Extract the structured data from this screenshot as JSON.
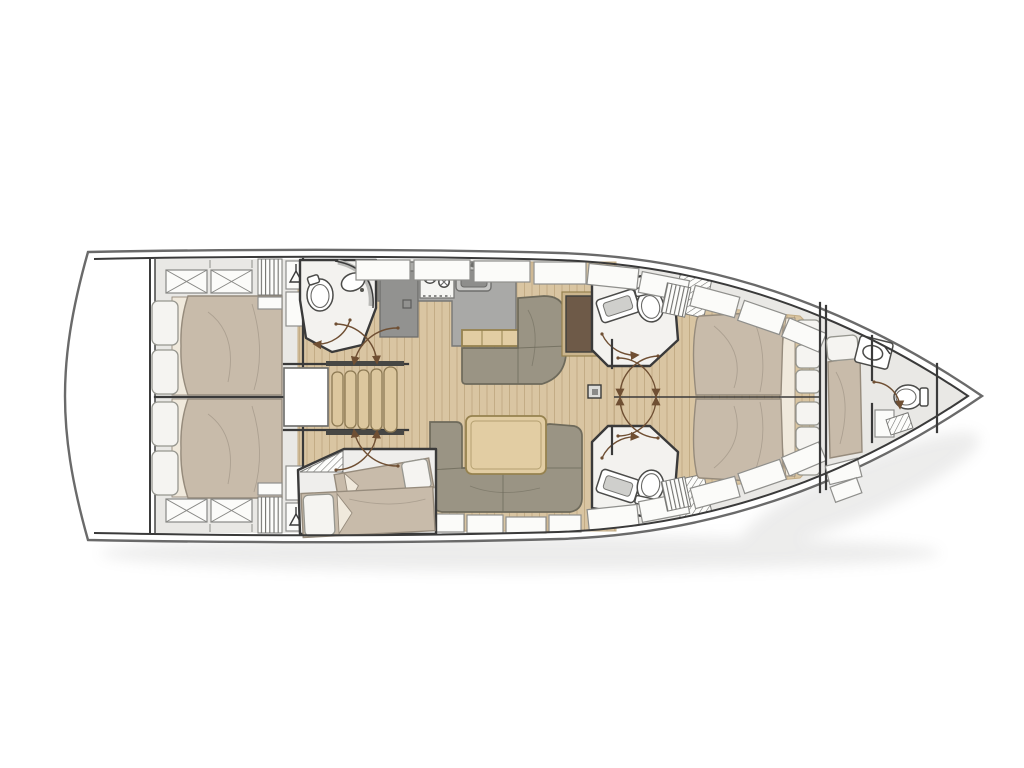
{
  "diagram": {
    "label": "sailing-yacht-interior-deck-plan",
    "background": "#ffffff"
  },
  "colors": {
    "background": "#ffffff",
    "hull_stroke": "#6a6a6a",
    "wall": "#3a3a3a",
    "deck": "#e9e8e5",
    "panel": "#fbfbf9",
    "panel_line": "#8f8f8c",
    "wood": "#d9c5a2",
    "wood_line": "#c3ac85",
    "table": "#e2cda3",
    "table_line": "#96824f",
    "mattress": "#c8bbaa",
    "mattress_line": "#968b7c",
    "sheet": "#f0e9dc",
    "pillow": "#f5f4f1",
    "pillow_line": "#96968f",
    "sofa": "#9a9484",
    "sofa_line": "#6e6a5b",
    "counter": "#a9a9a7",
    "counter_line": "#787876",
    "appliance": "#929290",
    "white_room": "#f3f2ef",
    "stair": "#dcc79e",
    "stair_line": "#8d7a54",
    "dark_panel": "#6e5a48",
    "door": "#6f4f33"
  },
  "areas": {
    "stern": "swim-platform",
    "aft_port": "aft-cabin-double-berth",
    "aft_starboard": "aft-cabin-double-berth",
    "companionway": "companionway-stairs",
    "galley": "galley-with-stove-sink-fridge",
    "aft_head": "aft-head-toilet-sink",
    "salon_top": "l-settee-with-chart-table",
    "salon_bottom": "u-sofa-with-dining-table",
    "mid_cabin": "midship-cabin-two-berths",
    "fwd_head_top": "forward-head-toilet-sink-shower",
    "fwd_head_bottom": "forward-head-toilet-sink-shower",
    "owner_cabin": "owner-cabin-island-berth",
    "crew_cabin": "bow-crew-cabin-berth",
    "bow_head": "bow-head-toilet-sink"
  }
}
